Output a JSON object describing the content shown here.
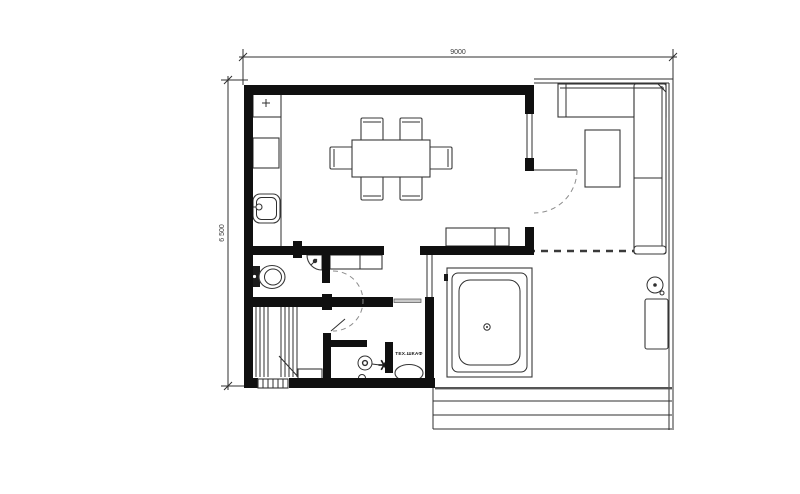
{
  "drawing": {
    "type": "architectural-floor-plan",
    "dimensions": {
      "width_label": "9000",
      "height_label": "6 500"
    },
    "labels": {
      "tech_cabinet": "ТЕХ.ШКАФ"
    },
    "colors": {
      "background": "#ffffff",
      "line": "#2f2f2f",
      "wall": "#101010",
      "dashed_door_swing": "#8c8c8c"
    }
  }
}
